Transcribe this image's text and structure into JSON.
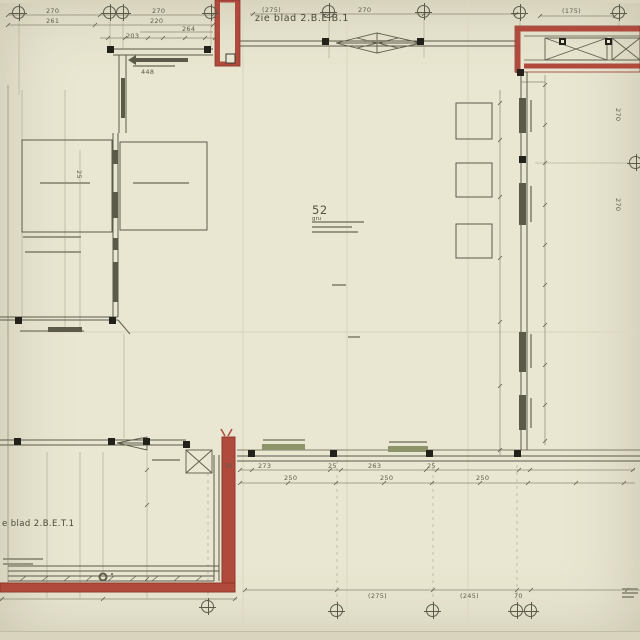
{
  "sheet": {
    "kind": "architectural floor plan (scanned technical drawing)",
    "top_reference": "zie blad 2.B.E.B.1",
    "bottom_reference": "e blad 2.B.E.T.1",
    "room": {
      "number": "52",
      "tag": "gru"
    }
  },
  "colors": {
    "paper": "#e9e6d1",
    "paper-edge": "#d8d4be",
    "ink": "#5c5b4a",
    "ink-light": "#8b8a74",
    "red": "#b04a3c",
    "red-dark": "#8f382c",
    "hatch-green": "#8d9469"
  },
  "dimensions": [
    {
      "x": 46,
      "y": 7,
      "t": "270"
    },
    {
      "x": 46,
      "y": 17,
      "t": "261"
    },
    {
      "x": 152,
      "y": 7,
      "t": "270"
    },
    {
      "x": 150,
      "y": 17,
      "t": "220"
    },
    {
      "x": 182,
      "y": 25,
      "t": "264"
    },
    {
      "x": 126,
      "y": 32,
      "t": "203"
    },
    {
      "x": 262,
      "y": 6,
      "t": "(275)"
    },
    {
      "x": 358,
      "y": 6,
      "t": "270"
    },
    {
      "x": 562,
      "y": 7,
      "t": "(175)"
    },
    {
      "x": 141,
      "y": 68,
      "t": "448"
    },
    {
      "x": 622,
      "y": 108,
      "t": "270",
      "rot": 90
    },
    {
      "x": 622,
      "y": 198,
      "t": "270",
      "rot": 90
    },
    {
      "x": 83,
      "y": 170,
      "t": "25",
      "rot": 90
    },
    {
      "x": 224,
      "y": 462,
      "t": "70"
    },
    {
      "x": 258,
      "y": 462,
      "t": "273"
    },
    {
      "x": 328,
      "y": 462,
      "t": "25"
    },
    {
      "x": 368,
      "y": 462,
      "t": "263"
    },
    {
      "x": 427,
      "y": 462,
      "t": "25"
    },
    {
      "x": 284,
      "y": 474,
      "t": "250"
    },
    {
      "x": 380,
      "y": 474,
      "t": "250"
    },
    {
      "x": 476,
      "y": 474,
      "t": "250"
    },
    {
      "x": 368,
      "y": 592,
      "t": "(275)"
    },
    {
      "x": 460,
      "y": 592,
      "t": "(245)"
    },
    {
      "x": 514,
      "y": 592,
      "t": "70"
    }
  ],
  "columns": [
    {
      "x": 107,
      "y": 46
    },
    {
      "x": 204,
      "y": 46
    },
    {
      "x": 322,
      "y": 38
    },
    {
      "x": 417,
      "y": 38
    },
    {
      "x": 517,
      "y": 69
    },
    {
      "x": 519,
      "y": 156
    },
    {
      "x": 15,
      "y": 317
    },
    {
      "x": 109,
      "y": 317
    },
    {
      "x": 14,
      "y": 438
    },
    {
      "x": 108,
      "y": 438
    },
    {
      "x": 143,
      "y": 438
    },
    {
      "x": 183,
      "y": 441
    },
    {
      "x": 248,
      "y": 450
    },
    {
      "x": 330,
      "y": 450
    },
    {
      "x": 426,
      "y": 450
    },
    {
      "x": 514,
      "y": 450
    }
  ],
  "grid_markers": [
    {
      "x": 19,
      "y": 13
    },
    {
      "x": 110,
      "y": 13
    },
    {
      "x": 123,
      "y": 13
    },
    {
      "x": 211,
      "y": 13
    },
    {
      "x": 329,
      "y": 12
    },
    {
      "x": 424,
      "y": 12
    },
    {
      "x": 520,
      "y": 13
    },
    {
      "x": 619,
      "y": 13
    },
    {
      "x": 636,
      "y": 163
    },
    {
      "x": 208,
      "y": 607
    },
    {
      "x": 337,
      "y": 611
    },
    {
      "x": 433,
      "y": 611
    },
    {
      "x": 517,
      "y": 611
    },
    {
      "x": 531,
      "y": 611
    }
  ]
}
